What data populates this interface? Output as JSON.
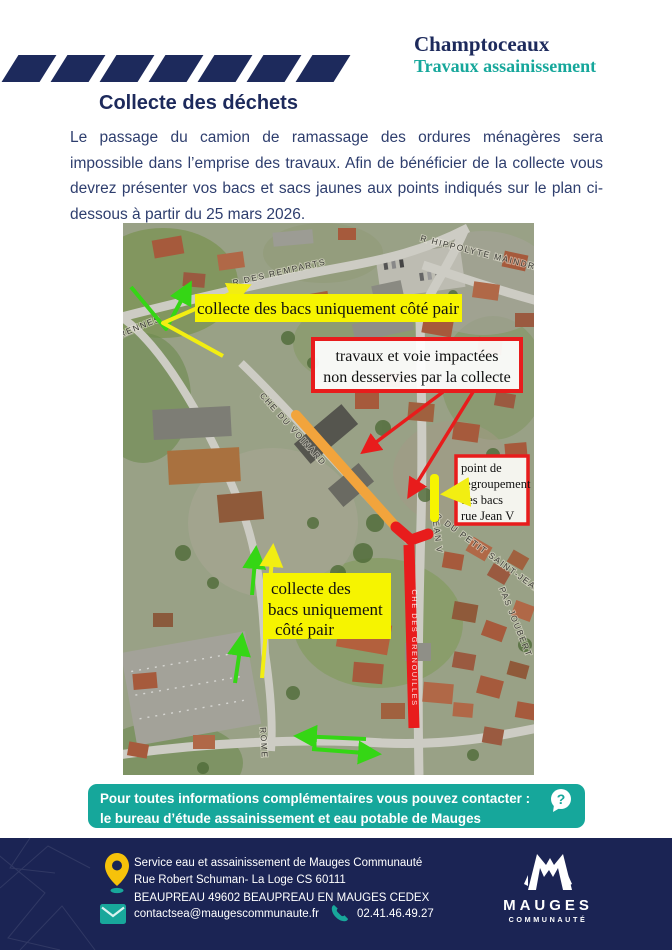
{
  "header": {
    "title": "Champtoceaux",
    "subtitle": "Travaux assainissement"
  },
  "section": {
    "heading": "Collecte des déchets",
    "paragraph": "Le passage du camion de ramassage des ordures ménagères sera impossible dans l’emprise des travaux. Afin de bénéficier de la collecte vous devrez présenter vos bacs et sacs jaunes aux points indiqués sur le plan ci-dessous à partir du 25 mars 2026."
  },
  "map": {
    "streets": {
      "remparts": "R DES REMPARTS",
      "hippolyte": "R HIPPOLYTE MAINDRON",
      "rennes": "RENNES",
      "voinard": "CHE DU VOINARD",
      "jean_v": "R JEAN V",
      "petit_saint_jean": "R DU PETIT SAINT-JEAN",
      "grenouilles": "CHE DES GRENOUILLES",
      "rome": "ROME",
      "pas_joubert": "PAS JOUBERT"
    },
    "labels": {
      "collect_top": "collecte des bacs uniquement côté pair",
      "works_l1": "travaux et voie impactées",
      "works_l2": "non desservies par la collecte",
      "regroup_l1": "point de",
      "regroup_l2": "regroupement",
      "regroup_l3": "des bacs",
      "regroup_l4": "rue Jean V",
      "collect_bottom_l1": "collecte des",
      "collect_bottom_l2": "bacs uniquement",
      "collect_bottom_l3": "côté pair"
    },
    "colors": {
      "impacted_red": "#e81c1c",
      "works_orange": "#f2a43c",
      "highlight_yellow": "#f6f400",
      "direction_green": "#35d615"
    }
  },
  "banner": {
    "line1": "Pour toutes informations complémentaires vous pouvez contacter :",
    "line2": "le bureau d’étude assainissement et eau potable de Mauges Communauté.",
    "icon": "?"
  },
  "footer": {
    "address_l1": "Service eau et assainissement de Mauges Communauté",
    "address_l2": "Rue Robert Schuman- La Loge CS 60111",
    "address_l3": "BEAUPREAU 49602 BEAUPREAU EN MAUGES CEDEX",
    "email": "contactsea@maugescommunaute.fr",
    "phone": "02.41.46.49.27",
    "logo_title": "MAUGES",
    "logo_subtitle": "COMMUNAUTÉ"
  }
}
